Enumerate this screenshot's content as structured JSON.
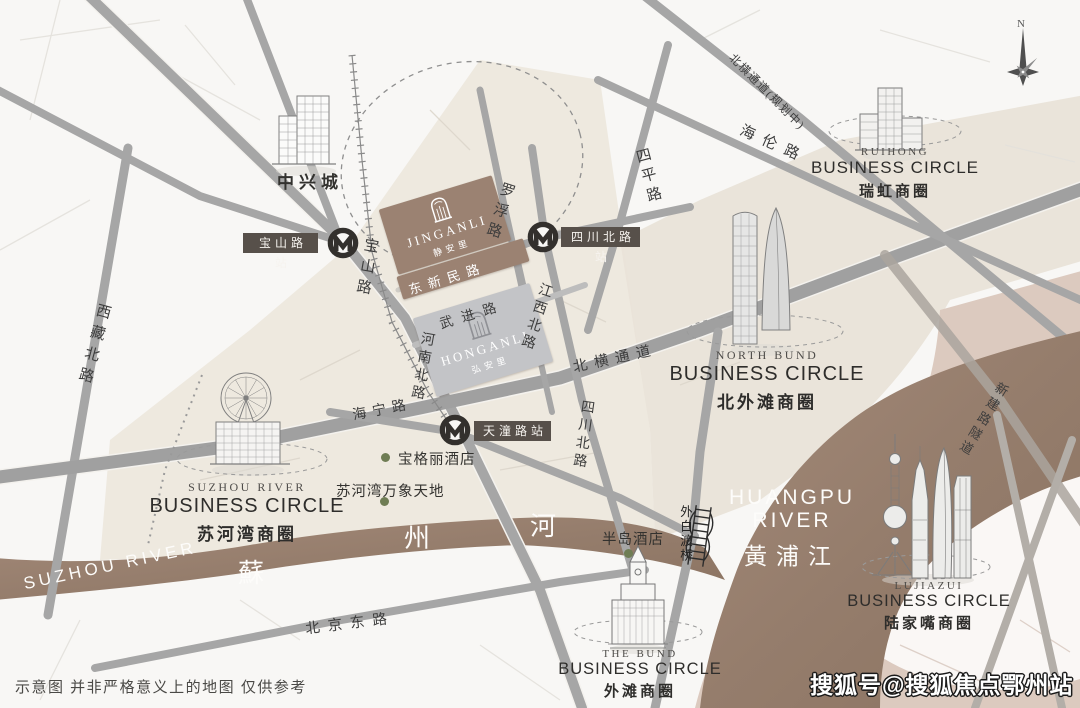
{
  "meta": {
    "disclaimer": "示意图 并非严格意义上的地图 仅供参考",
    "watermark": "搜狐号@搜狐焦点鄂州站",
    "compass": "N"
  },
  "projects": {
    "jinganli": {
      "en": "JINGANLI",
      "cn": "静安里"
    },
    "honganli": {
      "en": "HONGANLI",
      "cn": "弘安里"
    }
  },
  "stations": {
    "baoshanlu": "宝山路站",
    "sichuanbeilu": "四川北路站",
    "tiantonglu": "天潼路站"
  },
  "circles": {
    "ruihong": {
      "en": "RUIHONG",
      "label": "BUSINESS CIRCLE",
      "cn": "瑞虹商圈"
    },
    "northbund": {
      "en": "NORTH BUND",
      "label": "BUSINESS CIRCLE",
      "cn": "北外滩商圈"
    },
    "suzhouriver": {
      "en": "SUZHOU RIVER",
      "label": "BUSINESS CIRCLE",
      "cn": "苏河湾商圈"
    },
    "thebund": {
      "en": "THE BUND",
      "label": "BUSINESS CIRCLE",
      "cn": "外滩商圈"
    },
    "lujiazui": {
      "en": "LUJIAZUI",
      "label": "BUSINESS CIRCLE",
      "cn": "陆家嘴商圈"
    }
  },
  "roads": {
    "xizangbei": "西藏北路",
    "baoshan": "宝山路",
    "luofu": "罗浮路",
    "siping": "四平路",
    "hailun": "海伦路",
    "beihengplanned": "北横通道(规划中)",
    "dongxinmin": "东新民路",
    "wujin": "武进路",
    "jiangxibei": "江西北路",
    "beiheng": "北横通道",
    "henanbei": "河南北路",
    "haining": "海宁路",
    "sichuanbei": "四川北路",
    "beijingdong": "北京东路",
    "xinjian": "新建路隧道",
    "waibaidu": "外白渡桥"
  },
  "pois": {
    "zhongxingcheng": "中兴城",
    "bulgari": "宝格丽酒店",
    "mixc": "苏河湾万象天地",
    "peninsula": "半岛酒店"
  },
  "rivers": {
    "suzhou_en": "SUZHOU RIVER",
    "su": "蘇",
    "zhou": "州",
    "he": "河",
    "huangpu_en1": "HUANGPU",
    "huangpu_en2": "RIVER",
    "huangpu_cn": "黃浦江"
  },
  "colors": {
    "river": "#9a8170",
    "land_beige": "#ebe6dc",
    "pudong_tan": "#dccabf",
    "jinganli_block": "#9b8272",
    "honganli_block": "#c3c4c7",
    "station_badge": "#57504a",
    "poi_dot": "#6f7d54",
    "road_gray": "#a6a6a6"
  }
}
